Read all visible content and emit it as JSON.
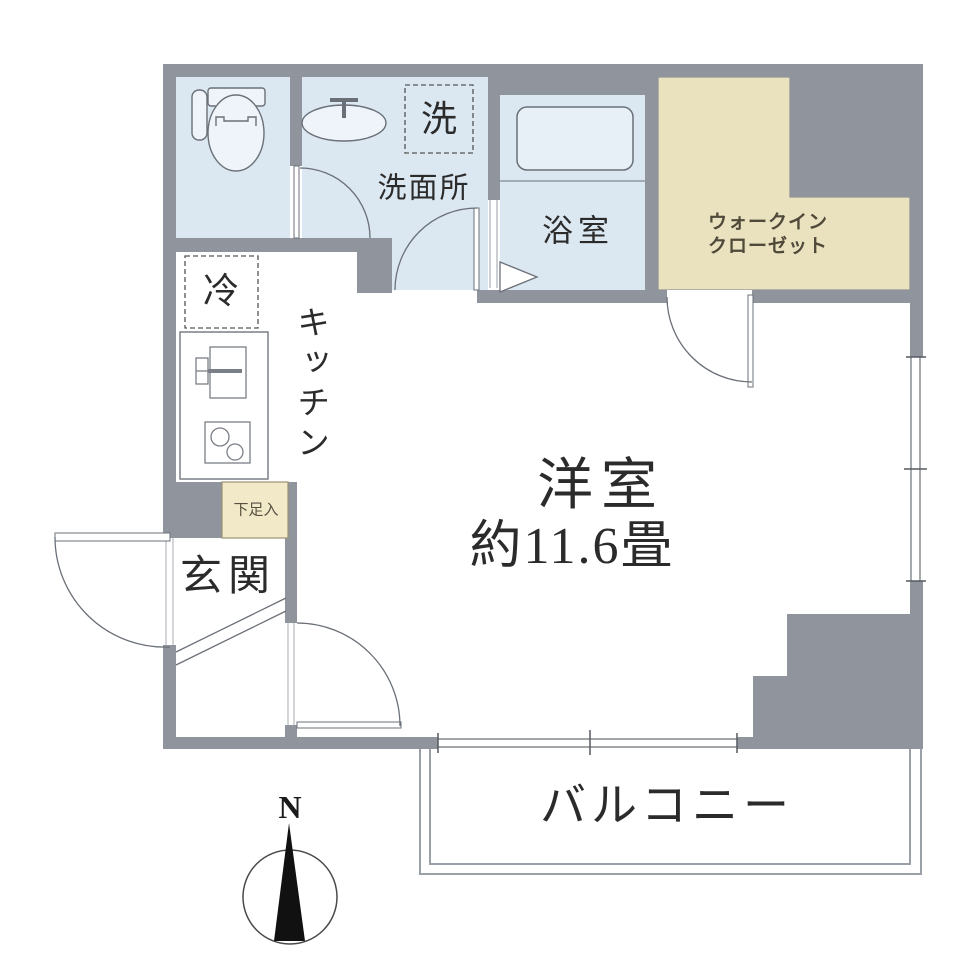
{
  "labels": {
    "laundry": "洗",
    "washroom": "洗面所",
    "bathroom": "浴室",
    "walk_in_closet_line1": "ウォークイン",
    "walk_in_closet_line2": "クローゼット",
    "refrigerator": "冷",
    "kitchen": "キッチン",
    "main_room_name": "洋室",
    "main_room_size": "約11.6畳",
    "entrance": "玄関",
    "shoe_cabinet": "下足入",
    "balcony": "バルコニー",
    "compass_north": "N"
  },
  "colors": {
    "wall": "#90949c",
    "wet_room_floor": "#dbe7f1",
    "closet_floor": "#eae1bf",
    "shoe_cabinet_fill": "#f2e9c9",
    "fixture_line": "#6b7078",
    "label_text": "#2b2b2b",
    "closet_text": "#4e4939"
  }
}
